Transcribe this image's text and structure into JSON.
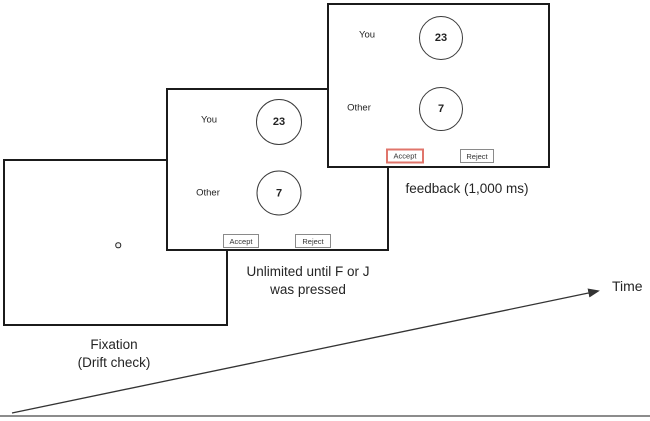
{
  "figure": {
    "screens": {
      "fixation": {
        "caption": [
          "Fixation",
          "(Drift check)"
        ]
      },
      "choice": {
        "you_label": "You",
        "you_value": "23",
        "other_label": "Other",
        "other_value": "7",
        "accept_label": "Accept",
        "reject_label": "Reject",
        "caption": [
          "Unlimited until F or J",
          "was pressed"
        ]
      },
      "feedback": {
        "you_label": "You",
        "you_value": "23",
        "other_label": "Other",
        "other_value": "7",
        "accept_label": "Accept",
        "reject_label": "Reject",
        "caption": "feedback (1,000 ms)"
      }
    },
    "timeline_label": "Time",
    "colors": {
      "panel_border": "#1b1b1b",
      "circle_stroke": "#3a3a3a",
      "button_border": "#8a8a8a",
      "accept_highlight_border": "#e0756b",
      "text": "#242424",
      "arrow": "#333333",
      "baseline": "#8c8c8c"
    }
  }
}
